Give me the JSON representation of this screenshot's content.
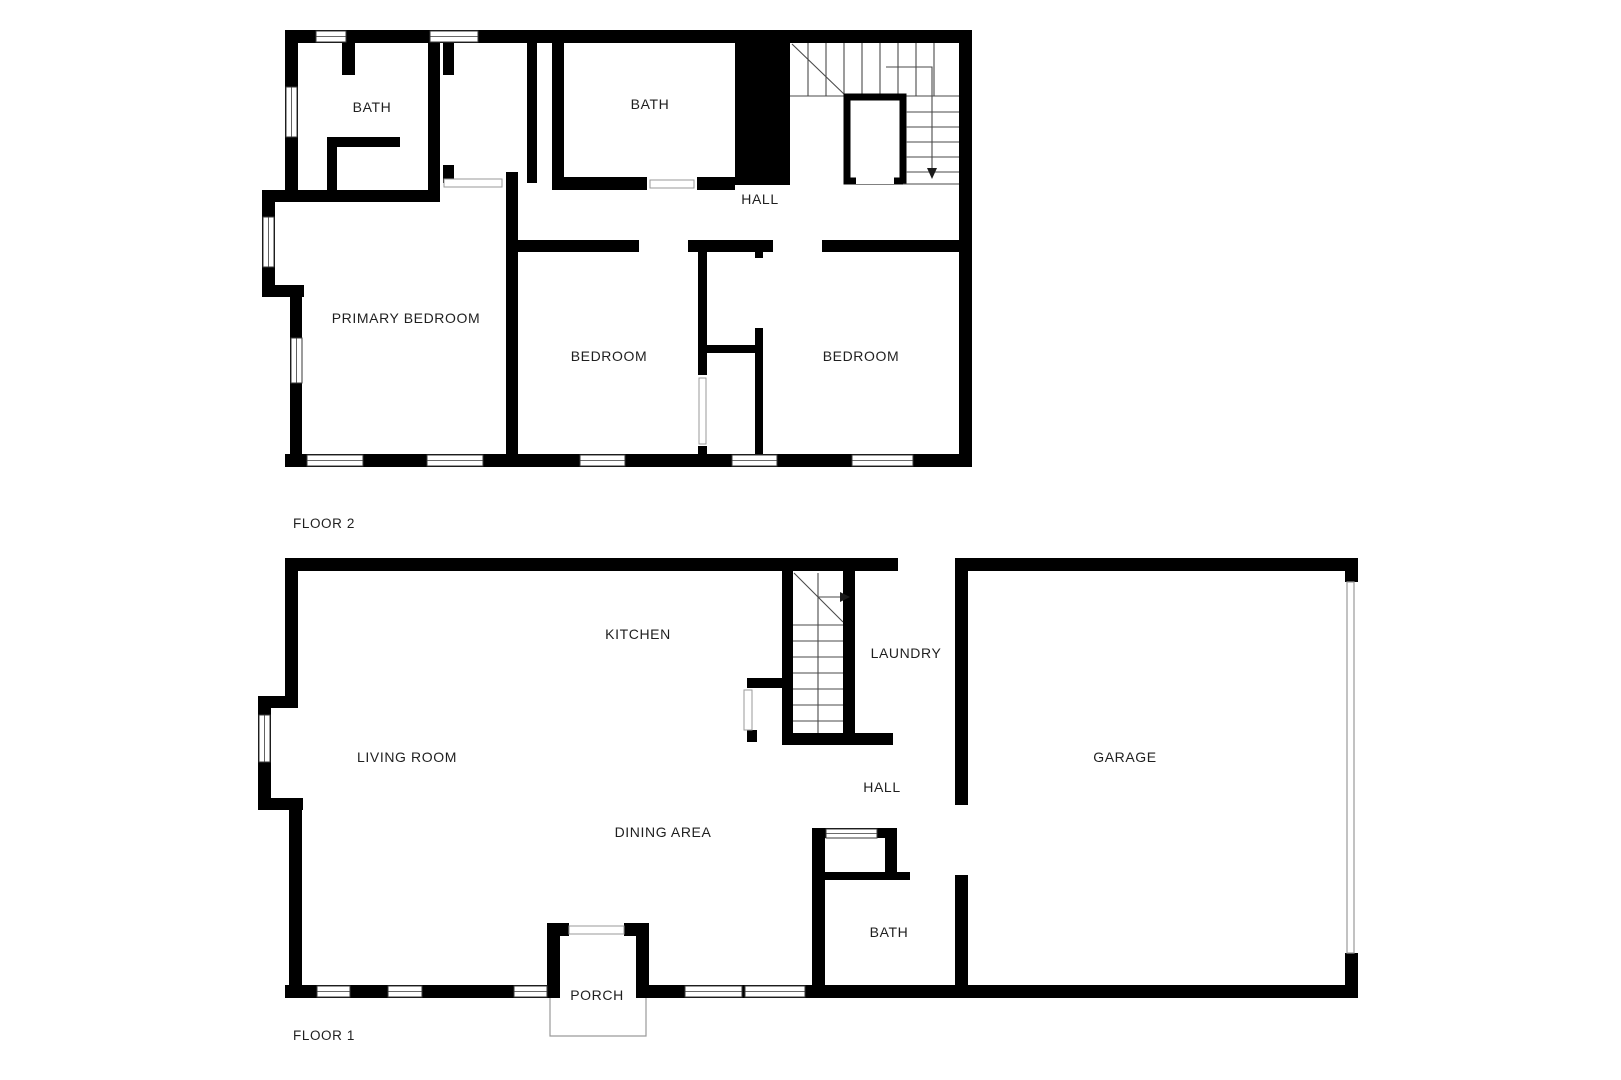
{
  "colors": {
    "background": "#ffffff",
    "wall": "#000000",
    "label_text": "#1f1f1f",
    "stair_line": "#4a4a4a",
    "thin_outline": "#9a9a9a"
  },
  "floor2": {
    "title": "FLOOR 2",
    "rooms": {
      "bath_left": "BATH",
      "bath_right": "BATH",
      "hall": "HALL",
      "primary_bedroom": "PRIMARY BEDROOM",
      "bedroom_middle": "BEDROOM",
      "bedroom_right": "BEDROOM"
    }
  },
  "floor1": {
    "title": "FLOOR 1",
    "rooms": {
      "kitchen": "KITCHEN",
      "laundry": "LAUNDRY",
      "living_room": "LIVING ROOM",
      "hall": "HALL",
      "garage": "GARAGE",
      "dining_area": "DINING AREA",
      "bath": "BATH",
      "porch": "PORCH"
    }
  }
}
